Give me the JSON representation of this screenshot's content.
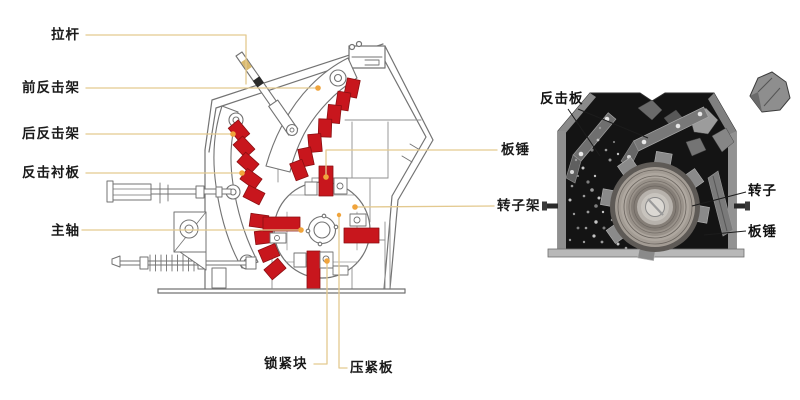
{
  "left_diagram": {
    "title_semantic": "impact crusher cross-section drawing",
    "labels": {
      "tie_rod": "拉杆",
      "front_impact_frame": "前反击架",
      "rear_impact_frame": "后反击架",
      "impact_liner": "反击衬板",
      "main_shaft": "主轴",
      "blow_bar": "板锤",
      "rotor_frame": "转子架",
      "locking_block": "锁紧块",
      "pressing_plate": "压紧板"
    }
  },
  "photo": {
    "title_semantic": "rotor chamber photograph",
    "labels": {
      "impact_plate": "反击板",
      "rotor": "转子",
      "blow_bar": "板锤"
    }
  },
  "colors": {
    "highlight_red": "#c8161d",
    "leader_line_tan": "#e3c98f",
    "marker_orange": "#f0a43c",
    "drawing_line_gray": "#737373",
    "label_text": "#1a1a1a",
    "photo_housing_black": "#141414"
  }
}
